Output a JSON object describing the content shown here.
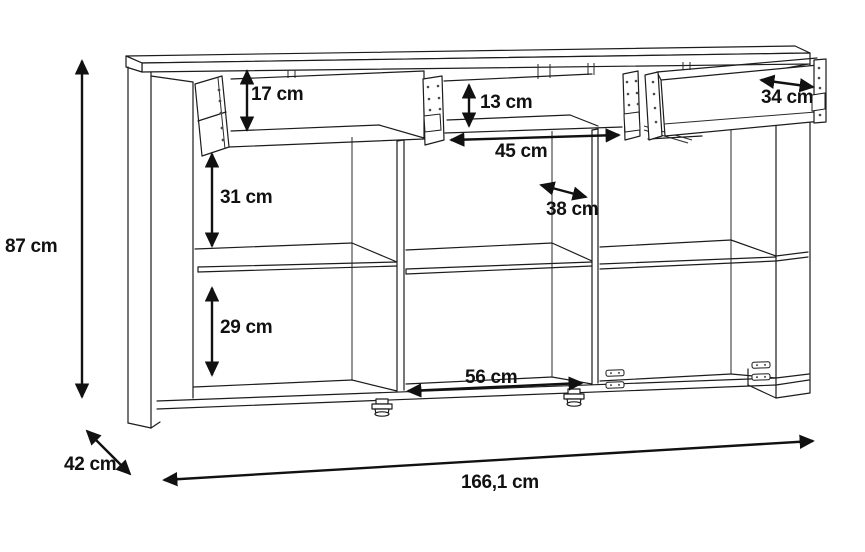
{
  "diagram": {
    "type": "furniture dimension line drawing",
    "item": "sideboard with three open drawers and six compartments",
    "unit": "cm",
    "colors": {
      "background": "#ffffff",
      "line": "#1c1c1c",
      "text": "#111111"
    },
    "dimensions": {
      "height": "87 cm",
      "depth": "42 cm",
      "width": "166,1 cm",
      "left_drawer_height": "17 cm",
      "middle_drawer_height": "13 cm",
      "drawer_side_depth": "34 cm",
      "drawer_inner_width": "45 cm",
      "shelf_depth": "38 cm",
      "upper_compartment_height": "31 cm",
      "lower_compartment_height": "29 cm",
      "bottom_middle_compartment_width": "56 cm"
    }
  }
}
